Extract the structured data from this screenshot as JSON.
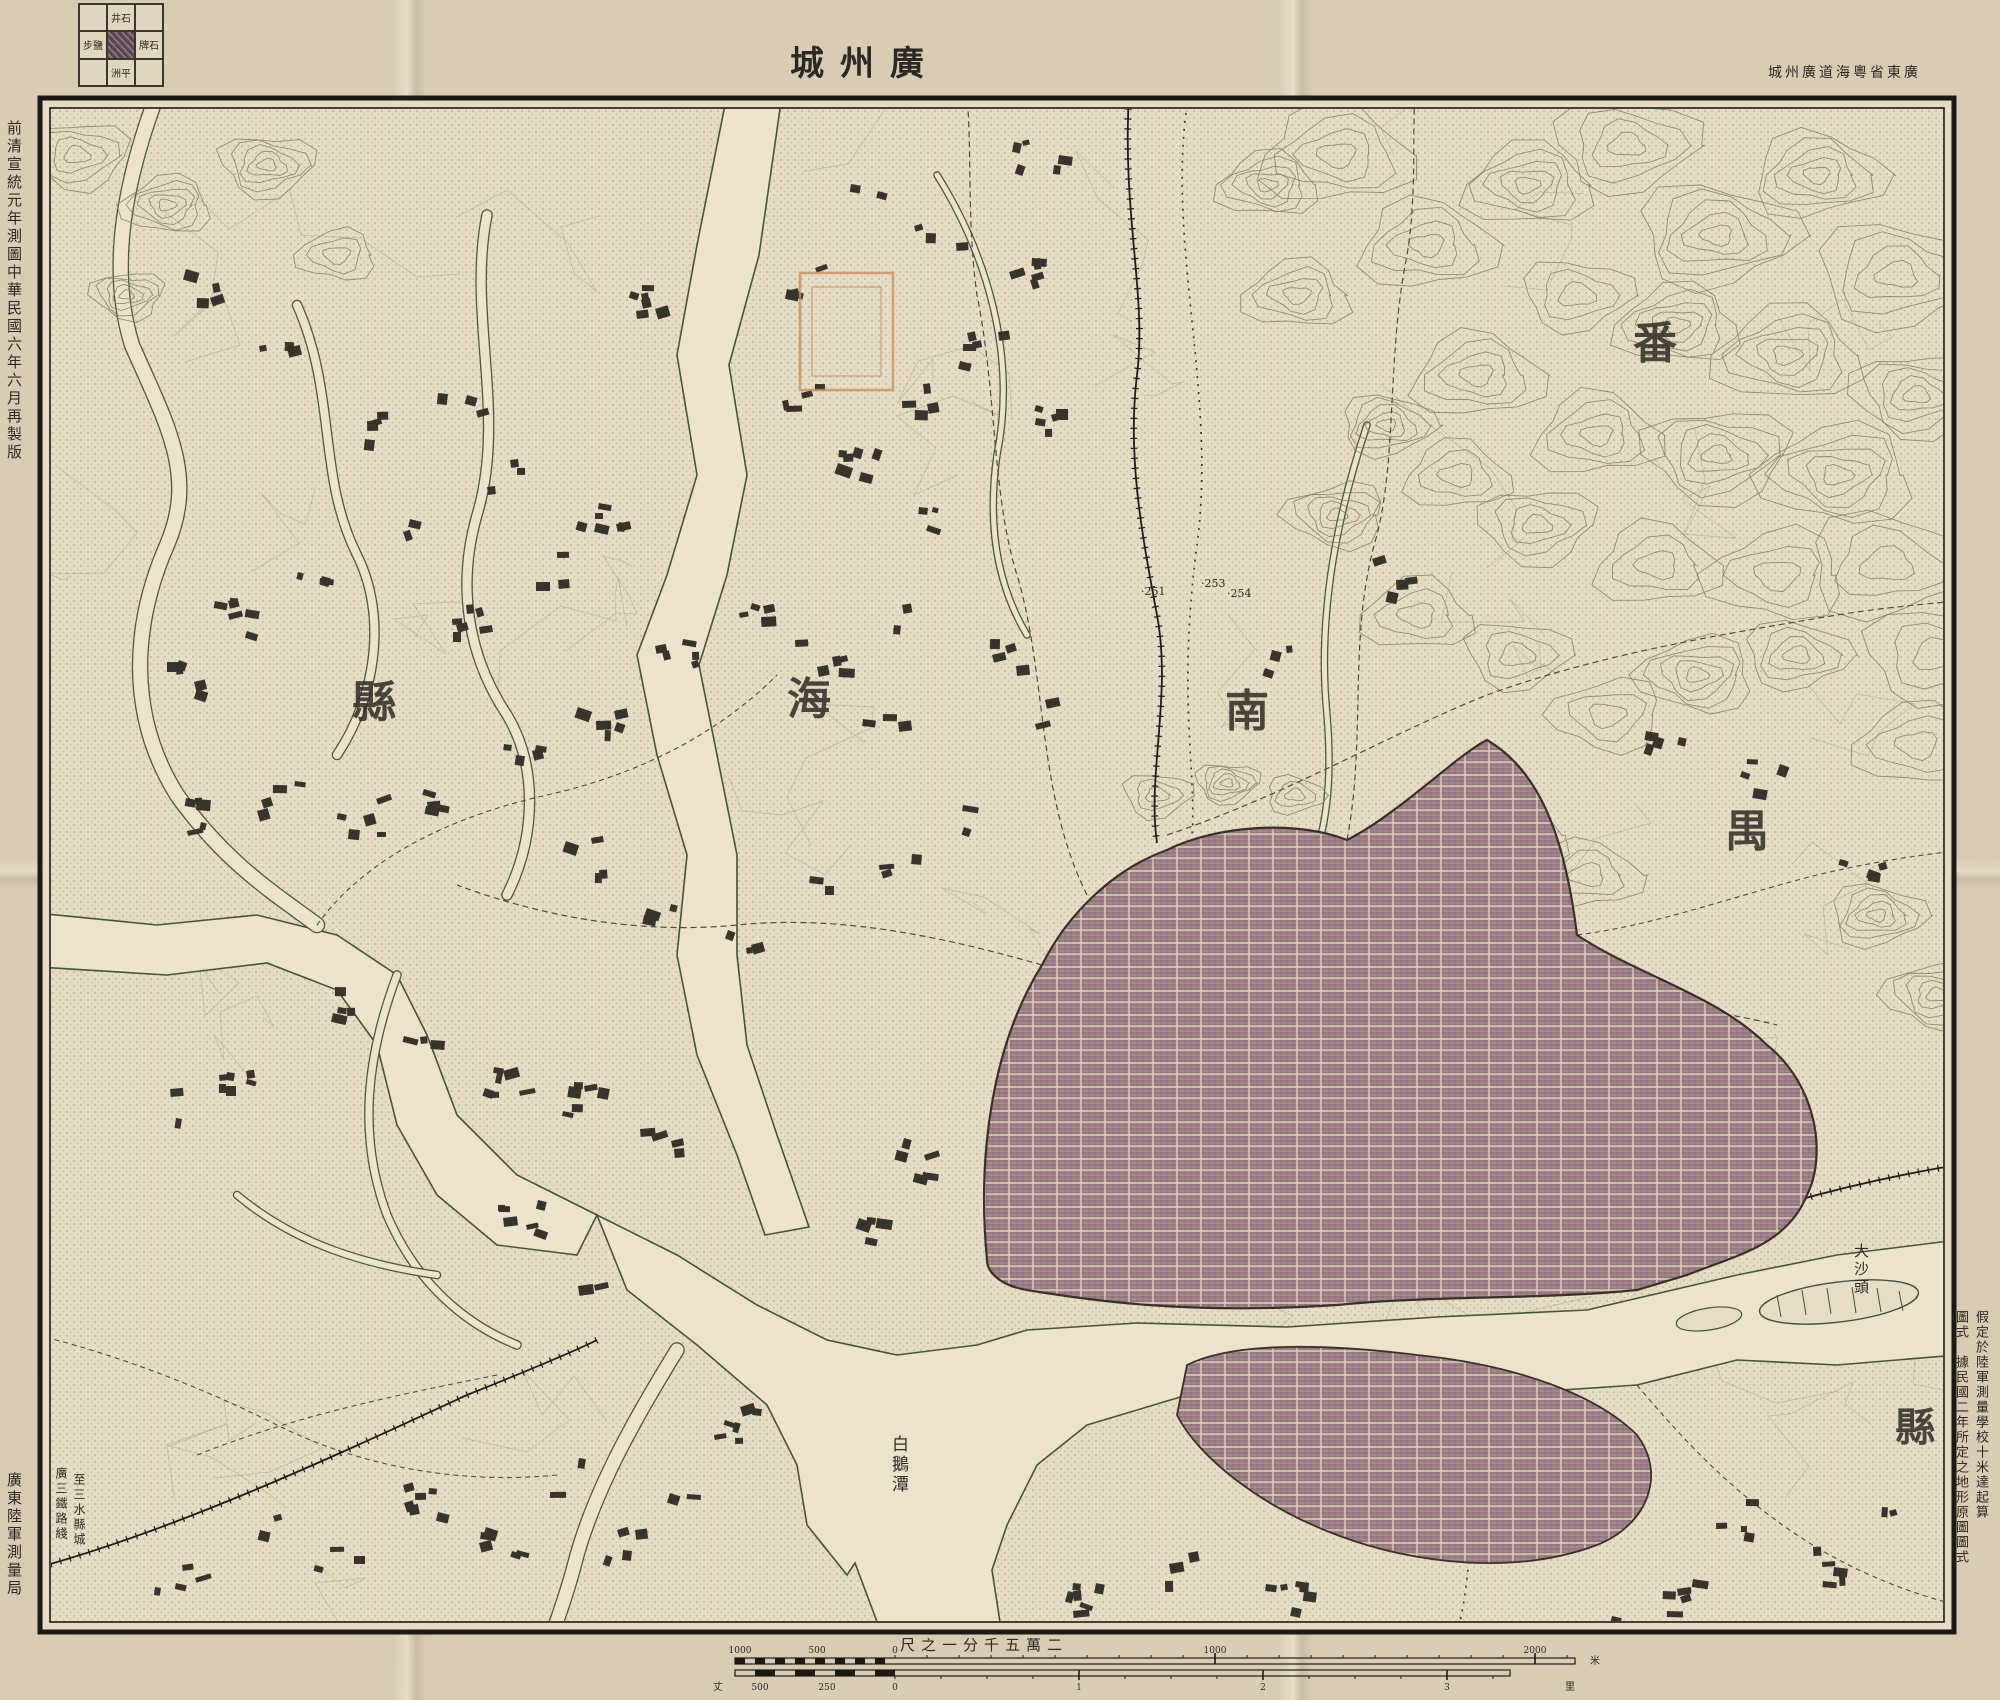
{
  "title": {
    "text": "廣州城",
    "rtl": true
  },
  "top_right_credit": {
    "text": "廣東省粵海道廣州城",
    "rtl": true
  },
  "margins": {
    "left_top": "前清宣統元年測圖中華民國六年六月再製版",
    "left_bottom": "廣東陸軍測量局",
    "right_bottom_col_first": "假定於陸軍測量學校十米達起算",
    "right_bottom_col_second": "圖式　據民國二年所定之地形原圖圖式"
  },
  "adjoining_sheets": {
    "north": "石井",
    "east": "石牌",
    "south": "平洲",
    "west": "鹽步",
    "center": ""
  },
  "scale": {
    "title": "二萬五千分一之尺",
    "title_rtl": true,
    "upper_labels": [
      "1000",
      "500",
      "0",
      "1000",
      "2000"
    ],
    "upper_unit": "米",
    "lower_left_unit": "丈",
    "lower_labels": [
      "500",
      "250",
      "0",
      "1",
      "2",
      "3"
    ],
    "lower_unit": "里"
  },
  "map_labels": [
    {
      "name": "county-nanhai-char-xian",
      "text": "縣",
      "x": 315,
      "y": 571,
      "size": 44
    },
    {
      "name": "county-nanhai-char-hai",
      "text": "海",
      "x": 750,
      "y": 568,
      "size": 44
    },
    {
      "name": "county-nanhai-char-nan",
      "text": "南",
      "x": 1188,
      "y": 580,
      "size": 44
    },
    {
      "name": "county-panyu-char-pan",
      "text": "番",
      "x": 1596,
      "y": 212,
      "size": 44
    },
    {
      "name": "county-panyu-char-yu",
      "text": "禺",
      "x": 1688,
      "y": 700,
      "size": 44
    },
    {
      "name": "county-panyu-char-xian",
      "text": "縣",
      "x": 1858,
      "y": 1300,
      "size": 40
    },
    {
      "name": "label-baietan",
      "text": "白鵝潭",
      "x": 852,
      "y": 1340,
      "size": 17,
      "vertical": true
    },
    {
      "name": "label-dashatou",
      "text": "大沙頭",
      "x": 1816,
      "y": 1148,
      "size": 15,
      "vertical": true
    },
    {
      "name": "label-to-sanshui",
      "text": "至三水縣城",
      "x": 36,
      "y": 1378,
      "size": 12,
      "vertical": true
    },
    {
      "name": "label-guangsan-rail",
      "text": "廣三鐵路綫",
      "x": 18,
      "y": 1372,
      "size": 12,
      "vertical": true
    },
    {
      "name": "spot-height-251",
      "text": "·251",
      "x": 1104,
      "y": 490,
      "size": 11
    },
    {
      "name": "spot-height-253",
      "text": "·253",
      "x": 1164,
      "y": 482,
      "size": 11
    },
    {
      "name": "spot-height-254",
      "text": "·254",
      "x": 1190,
      "y": 492,
      "size": 11
    }
  ],
  "colors": {
    "paper": "#d6c9b0",
    "map_face": "#e6dcc3",
    "ink": "#2c2822",
    "water_line": "#47573d",
    "contour": "#7c8258",
    "city_fill": "#a2838c",
    "stain_pink": "#c89a8e"
  }
}
